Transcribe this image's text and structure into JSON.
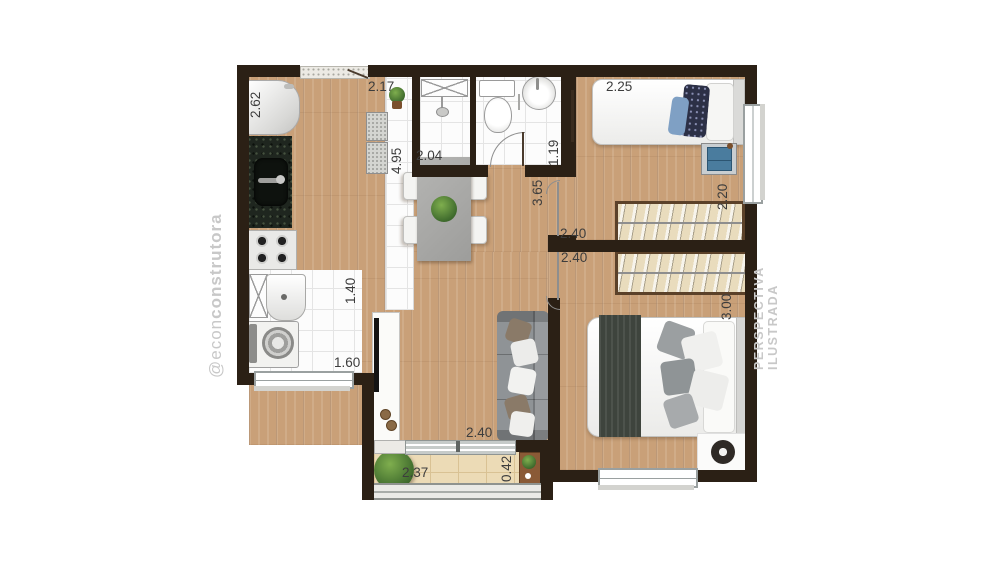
{
  "watermarks": {
    "left_prefix": "@econ",
    "left_bold": "construtora",
    "right": "PERSPECTIVA ILUSTRADA"
  },
  "dimensions": {
    "kitchen_fridge_wall": "2.62",
    "entry_width": "2.17",
    "kitchen_living_length": "4.95",
    "bathroom_width": "2.04",
    "bathroom_depth": "1.19",
    "hall_length": "3.65",
    "bedroom1_bed_wall": "2.25",
    "bedroom1_depth": "2.20",
    "bedroom1_wardrobe_wall": "2.40",
    "bedroom2_wardrobe_wall": "2.40",
    "bedroom2_depth": "3.00",
    "laundry_depth": "1.40",
    "laundry_width": "1.60",
    "living_width": "2.40",
    "balcony_width": "2.37",
    "balcony_counter_depth": "0.42"
  },
  "colors": {
    "wall": "#2b2015",
    "wood": "#c9a078",
    "balc": "#ecdbb6",
    "wrob": "#e9dcbd",
    "wrobb": "#5b4129",
    "granite": "#1f261f",
    "sofa": "#8f9396",
    "wm": "#c8c8c8",
    "dim": "#3d3d3d"
  }
}
